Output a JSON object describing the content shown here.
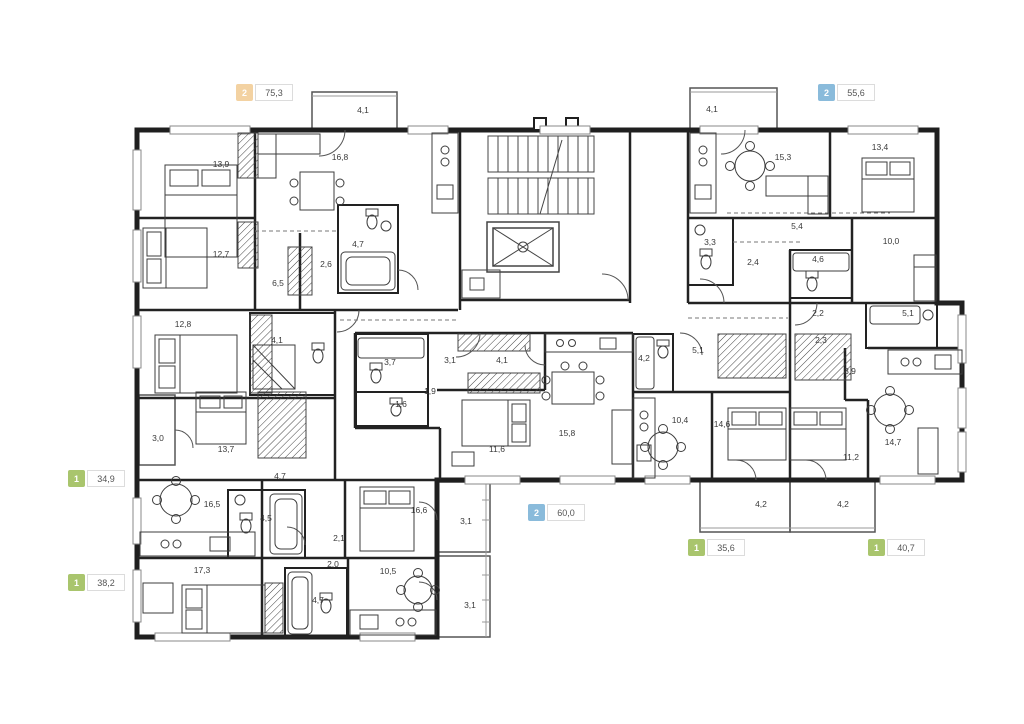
{
  "plan": {
    "background": "#ffffff",
    "wall_color": "#1f1f1f"
  },
  "colors": {
    "green": "#a9c56d",
    "blue": "#8abbdb",
    "orange": "#f3d2a2"
  },
  "badges": [
    {
      "rooms": "2",
      "area": "75,3",
      "color": "orange",
      "x": 236,
      "y": 84
    },
    {
      "rooms": "2",
      "area": "55,6",
      "color": "blue",
      "x": 818,
      "y": 84
    },
    {
      "rooms": "1",
      "area": "34,9",
      "color": "green",
      "x": 68,
      "y": 470
    },
    {
      "rooms": "1",
      "area": "38,2",
      "color": "green",
      "x": 68,
      "y": 574
    },
    {
      "rooms": "2",
      "area": "60,0",
      "color": "blue",
      "x": 528,
      "y": 504
    },
    {
      "rooms": "1",
      "area": "35,6",
      "color": "green",
      "x": 688,
      "y": 539
    },
    {
      "rooms": "1",
      "area": "40,7",
      "color": "green",
      "x": 868,
      "y": 539
    }
  ],
  "rooms": [
    {
      "label": "4,1",
      "x": 363,
      "y": 113
    },
    {
      "label": "13,9",
      "x": 221,
      "y": 167
    },
    {
      "label": "16,8",
      "x": 340,
      "y": 160
    },
    {
      "label": "12,7",
      "x": 221,
      "y": 257
    },
    {
      "label": "4,7",
      "x": 358,
      "y": 247
    },
    {
      "label": "2,6",
      "x": 326,
      "y": 267
    },
    {
      "label": "6,5",
      "x": 278,
      "y": 286
    },
    {
      "label": "4,1",
      "x": 712,
      "y": 112
    },
    {
      "label": "15,3",
      "x": 783,
      "y": 160
    },
    {
      "label": "13,4",
      "x": 880,
      "y": 150
    },
    {
      "label": "3,3",
      "x": 710,
      "y": 245
    },
    {
      "label": "5,4",
      "x": 797,
      "y": 229
    },
    {
      "label": "2,4",
      "x": 753,
      "y": 265
    },
    {
      "label": "4,6",
      "x": 818,
      "y": 262
    },
    {
      "label": "10,0",
      "x": 891,
      "y": 244
    },
    {
      "label": "12,8",
      "x": 183,
      "y": 327
    },
    {
      "label": "4,1",
      "x": 277,
      "y": 343
    },
    {
      "label": "3,0",
      "x": 158,
      "y": 441
    },
    {
      "label": "13,7",
      "x": 226,
      "y": 452
    },
    {
      "label": "4,7",
      "x": 280,
      "y": 479
    },
    {
      "label": "16,5",
      "x": 212,
      "y": 507
    },
    {
      "label": "4,5",
      "x": 266,
      "y": 521
    },
    {
      "label": "2,1",
      "x": 339,
      "y": 541
    },
    {
      "label": "16,6",
      "x": 419,
      "y": 513
    },
    {
      "label": "3,1",
      "x": 466,
      "y": 524
    },
    {
      "label": "17,3",
      "x": 202,
      "y": 573
    },
    {
      "label": "2,0",
      "x": 333,
      "y": 567
    },
    {
      "label": "4,7",
      "x": 318,
      "y": 603
    },
    {
      "label": "10,5",
      "x": 388,
      "y": 574
    },
    {
      "label": "3,1",
      "x": 470,
      "y": 608
    },
    {
      "label": "3,7",
      "x": 390,
      "y": 365
    },
    {
      "label": "3,1",
      "x": 450,
      "y": 363
    },
    {
      "label": "4,1",
      "x": 502,
      "y": 363
    },
    {
      "label": "1,9",
      "x": 430,
      "y": 394
    },
    {
      "label": "1,6",
      "x": 401,
      "y": 407
    },
    {
      "label": "11,6",
      "x": 497,
      "y": 452
    },
    {
      "label": "15,8",
      "x": 567,
      "y": 436
    },
    {
      "label": "4,2",
      "x": 644,
      "y": 361
    },
    {
      "label": "5,1",
      "x": 698,
      "y": 353
    },
    {
      "label": "10,4",
      "x": 680,
      "y": 423
    },
    {
      "label": "14,6",
      "x": 722,
      "y": 427
    },
    {
      "label": "4,2",
      "x": 761,
      "y": 507
    },
    {
      "label": "2,2",
      "x": 818,
      "y": 316
    },
    {
      "label": "5,1",
      "x": 908,
      "y": 316
    },
    {
      "label": "2,3",
      "x": 821,
      "y": 343
    },
    {
      "label": "3,9",
      "x": 850,
      "y": 374
    },
    {
      "label": "11,2",
      "x": 851,
      "y": 460
    },
    {
      "label": "14,7",
      "x": 893,
      "y": 445
    },
    {
      "label": "4,2",
      "x": 843,
      "y": 507
    }
  ]
}
